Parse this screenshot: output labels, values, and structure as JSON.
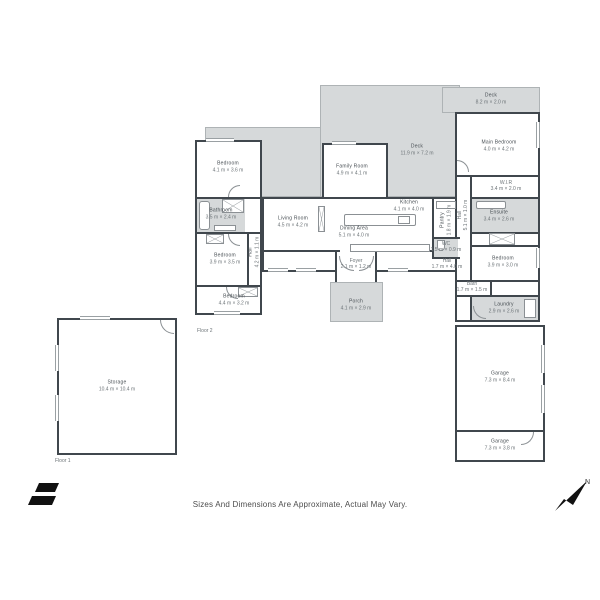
{
  "disclaimer": "Sizes And Dimensions Are Approximate, Actual May Vary.",
  "plan_labels": {
    "floor1": "Floor 1",
    "floor2": "Floor 2",
    "north": "N"
  },
  "colors": {
    "wall": "#40474d",
    "deck_fill": "#d6d9da",
    "room_fill": "#ffffff",
    "label_text": "#474e53",
    "brand_black": "#111111"
  },
  "rooms": {
    "bedroom_top_left": {
      "name": "Bedroom",
      "dims": "4.1 m × 3.6 m"
    },
    "bathroom": {
      "name": "Bathroom",
      "dims": "3.5 m × 2.4 m"
    },
    "bedroom_mid_left": {
      "name": "Bedroom",
      "dims": "3.9 m × 3.5 m"
    },
    "bedroom_bottom_left": {
      "name": "Bedroom",
      "dims": "4.4 m × 3.2 m"
    },
    "hall_left": {
      "name": "Hall",
      "dims": "4.2 m × 1.1 m"
    },
    "family_room": {
      "name": "Family Room",
      "dims": "4.9 m × 4.1 m"
    },
    "living_room": {
      "name": "Living Room",
      "dims": "4.5 m × 4.2 m"
    },
    "dining_area": {
      "name": "Dining Area",
      "dims": "5.1 m × 4.0 m"
    },
    "kitchen": {
      "name": "Kitchen",
      "dims": "4.1 m × 4.0 m"
    },
    "pantry": {
      "name": "Pantry",
      "dims": "1.8 m × 1.9 m"
    },
    "wc": {
      "name": "WC",
      "dims": "1.5 m × 0.9 m"
    },
    "hall_center": {
      "name": "Hall",
      "dims": "1.7 m × 4.0 m"
    },
    "foyer": {
      "name": "Foyer",
      "dims": "2.1 m × 1.2 m"
    },
    "porch": {
      "name": "Porch",
      "dims": "4.1 m × 2.9 m"
    },
    "deck_main": {
      "name": "Deck",
      "dims": "11.9 m × 7.2 m"
    },
    "deck_top": {
      "name": "Deck",
      "dims": "8.2 m × 2.0 m"
    },
    "main_bedroom": {
      "name": "Main Bedroom",
      "dims": "4.0 m × 4.2 m"
    },
    "wir": {
      "name": "W.I.R",
      "dims": "3.4 m × 2.0 m"
    },
    "ensuite": {
      "name": "Ensuite",
      "dims": "3.4 m × 2.6 m"
    },
    "hall_right": {
      "name": "Hall",
      "dims": "5.1 m × 1.0 m"
    },
    "bedroom_right": {
      "name": "Bedroom",
      "dims": "3.9 m × 3.0 m"
    },
    "bath": {
      "name": "Bath",
      "dims": "1.7 m × 1.5 m"
    },
    "laundry": {
      "name": "Laundry",
      "dims": "2.9 m × 2.6 m"
    },
    "garage_main": {
      "name": "Garage",
      "dims": "7.3 m × 8.4 m"
    },
    "garage_second": {
      "name": "Garage",
      "dims": "7.3 m × 3.8 m"
    },
    "storage": {
      "name": "Storage",
      "dims": "10.4 m × 10.4 m"
    }
  }
}
